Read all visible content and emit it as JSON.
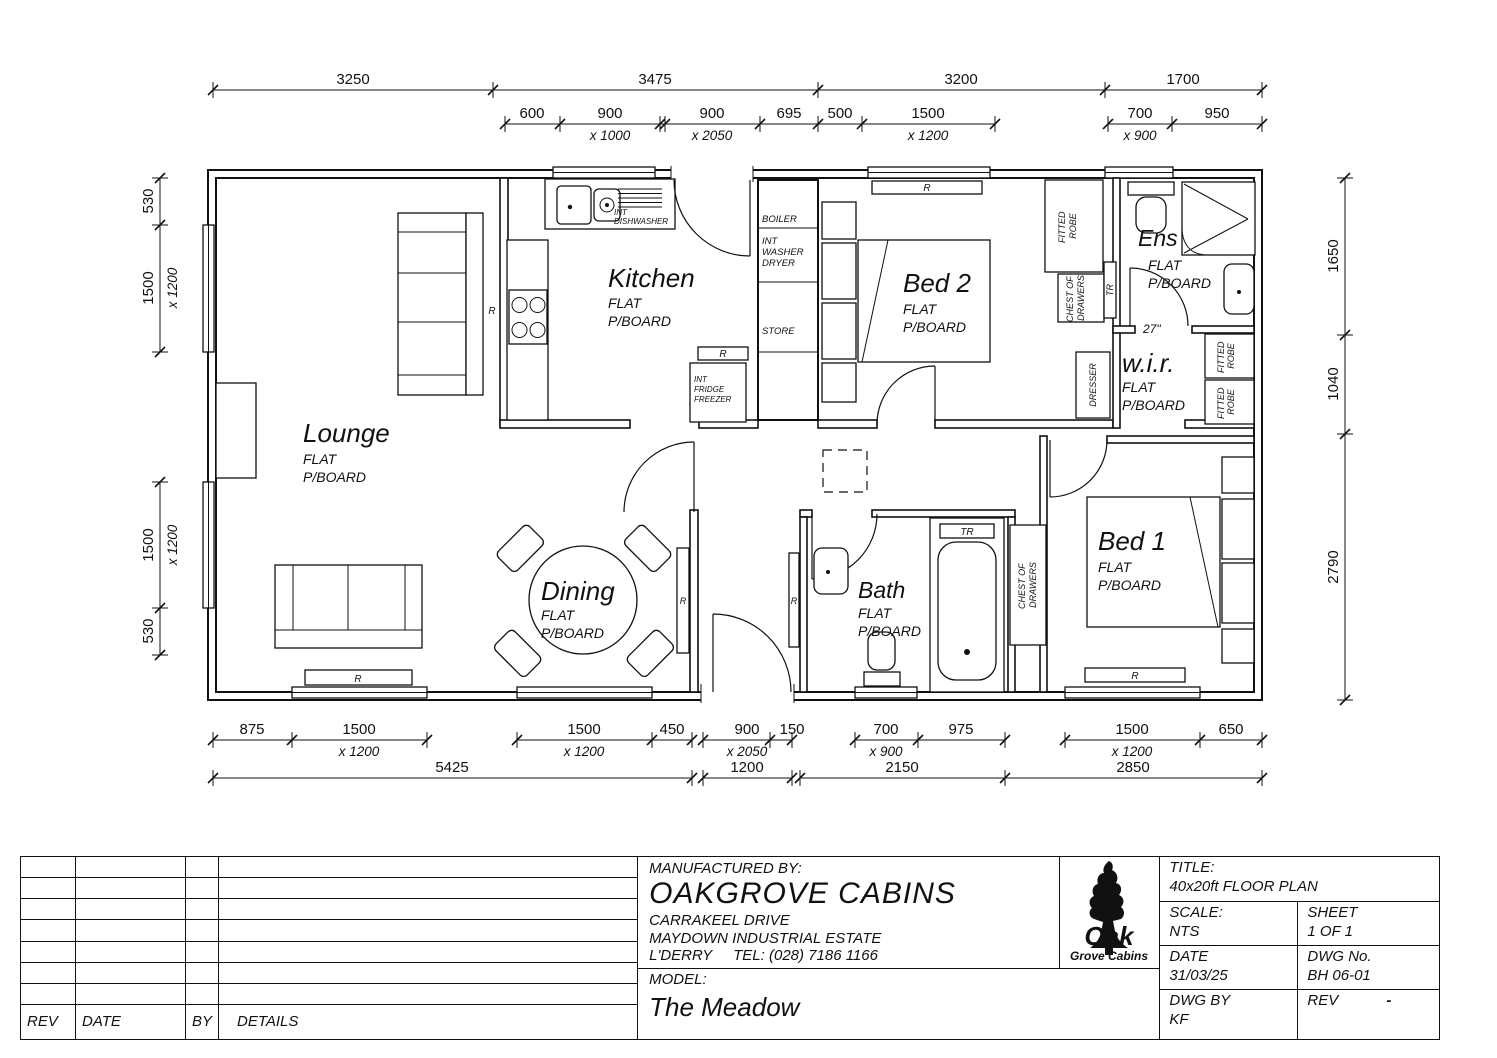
{
  "plan": {
    "rooms": {
      "lounge": {
        "name": "Lounge"
      },
      "kitchen": {
        "name": "Kitchen"
      },
      "dining": {
        "name": "Dining"
      },
      "bath": {
        "name": "Bath"
      },
      "bed1": {
        "name": "Bed 1"
      },
      "bed2": {
        "name": "Bed 2"
      },
      "ens": {
        "name": "Ens"
      },
      "wir": {
        "name": "w.i.r."
      }
    },
    "finish": {
      "l1": "FLAT",
      "l2": "P/BOARD"
    },
    "fixtures": {
      "boiler": "BOILER",
      "washer": [
        "INT",
        "WASHER",
        "DRYER"
      ],
      "store": "STORE",
      "fridge": [
        "INT",
        "FRIDGE",
        "FREEZER"
      ],
      "dishwasher": [
        "INT",
        "DISHWASHER"
      ],
      "fitted_robe": [
        "FITTED",
        "ROBE"
      ],
      "chest": [
        "CHEST OF",
        "DRAWERS"
      ],
      "dresser": "DRESSER",
      "radiator": "R",
      "towel_rail": "TR",
      "door_width": "27\""
    },
    "dims": {
      "top1": [
        "3250",
        "3475",
        "3200",
        "1700"
      ],
      "top2": [
        {
          "v": "600",
          "s": ""
        },
        {
          "v": "900",
          "s": "x 1000"
        },
        {
          "v": "900",
          "s": "x 2050"
        },
        {
          "v": "695",
          "s": ""
        },
        {
          "v": "500",
          "s": ""
        },
        {
          "v": "1500",
          "s": "x 1200"
        },
        {
          "v": "700",
          "s": "x 900"
        },
        {
          "v": "950",
          "s": ""
        }
      ],
      "left": [
        {
          "v": "530",
          "s": ""
        },
        {
          "v": "1500",
          "s": "x 1200"
        },
        {
          "v": "1500",
          "s": "x 1200"
        },
        {
          "v": "530",
          "s": ""
        }
      ],
      "right": [
        "1650",
        "1040",
        "2790"
      ],
      "bottom1": [
        {
          "v": "875",
          "s": ""
        },
        {
          "v": "1500",
          "s": "x 1200"
        },
        {
          "v": "1500",
          "s": "x 1200"
        },
        {
          "v": "450",
          "s": ""
        },
        {
          "v": "900",
          "s": "x 2050"
        },
        {
          "v": "150",
          "s": ""
        },
        {
          "v": "700",
          "s": "x 900"
        },
        {
          "v": "975",
          "s": ""
        },
        {
          "v": "1500",
          "s": "x 1200"
        },
        {
          "v": "650",
          "s": ""
        }
      ],
      "bottom2": [
        "5425",
        "1200",
        "2150",
        "2850"
      ]
    }
  },
  "titleblock": {
    "manufactured_label": "MANUFACTURED BY:",
    "company": "OAKGROVE CABINS",
    "address1": "CARRAKEEL DRIVE",
    "address2": "MAYDOWN INDUSTRIAL ESTATE",
    "address3": "L'DERRY",
    "tel": "TEL: (028) 7186 1166",
    "model_label": "MODEL:",
    "model": "The Meadow",
    "title_label": "TITLE:",
    "title": "40x20ft FLOOR PLAN",
    "scale_label": "SCALE:",
    "scale": "NTS",
    "sheet_label": "SHEET",
    "sheet": "1 OF 1",
    "date_label": "DATE",
    "date": "31/03/25",
    "dwgno_label": "DWG No.",
    "dwgno": "BH 06-01",
    "dwgby_label": "DWG BY",
    "dwgby": "KF",
    "rev_label": "REV",
    "rev": "-",
    "logo": {
      "line1": "Oak",
      "line2": "Grove Cabins"
    }
  },
  "revtable": {
    "headers": [
      "REV",
      "DATE",
      "BY",
      "DETAILS"
    ]
  }
}
